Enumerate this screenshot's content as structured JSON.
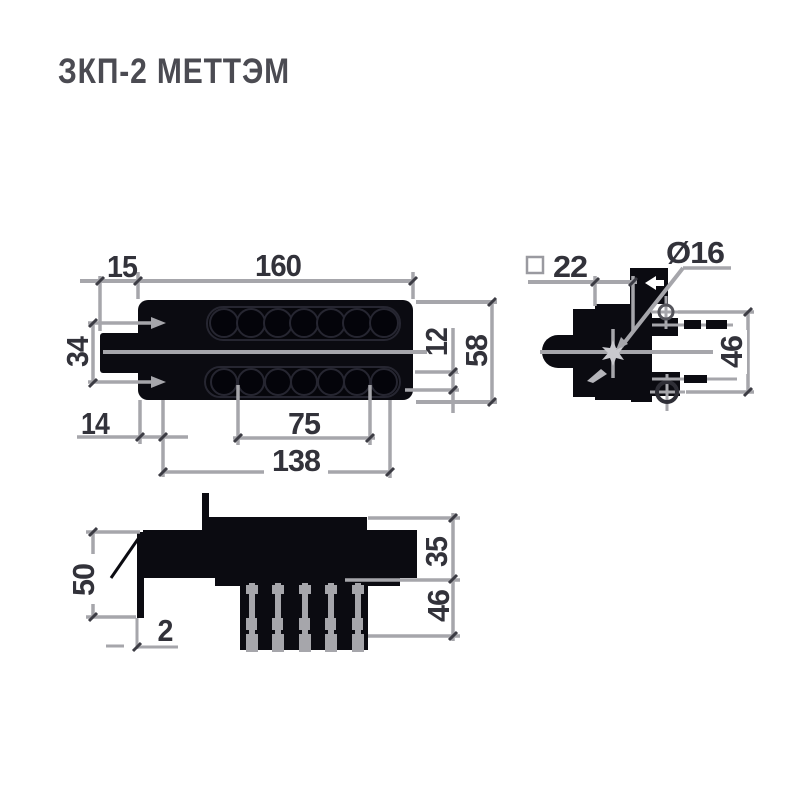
{
  "title": "ЗКП-2 МЕТТЭМ",
  "colors": {
    "ink_black": "#0b0b11",
    "line_gray": "#a6a6ab",
    "dim_text": "#32323a",
    "title_text": "#4b4b52"
  },
  "front_view": {
    "dim_bolt_offset": "15",
    "dim_body_width": "160",
    "dim_row_spacing": "34",
    "dim_edge_offset": "14",
    "dim_hole_span": "75",
    "dim_mount_span": "138",
    "dim_hole_width": "12",
    "dim_body_height": "58"
  },
  "side_view": {
    "dim_square_size": "22",
    "dim_cylinder_dia": "Ø16",
    "dim_hole_spacing": "46"
  },
  "bottom_view": {
    "dim_plate_height": "50",
    "dim_plate_thickness": "2",
    "dim_body_depth": "35",
    "dim_screw_depth": "46"
  }
}
